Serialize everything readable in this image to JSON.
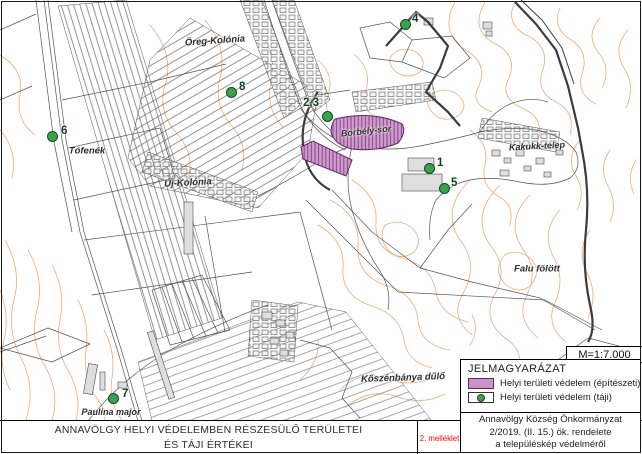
{
  "title_block": {
    "line1": "ANNAVÖLGY HELYI VÉDELEMBEN RÉSZESÜLŐ TERÜLETEI",
    "line2": "ÉS TÁJI ÉRTÉKEI"
  },
  "annex_label": "2. melléklet",
  "scale_label": "M=1:7.000",
  "legend": {
    "title": "JELMAGYARÁZAT",
    "items": [
      {
        "type": "area",
        "label": "Helyi területi védelem (építészeti)",
        "fill": "#cb92c6",
        "border": "#5c2a60"
      },
      {
        "type": "point",
        "label": "Helyi területi védelem (táji)",
        "fill": "#3aa24d",
        "border": "#1c4a23"
      }
    ]
  },
  "attribution": {
    "line1": "Annavölgy Község Önkormányzat",
    "line2": "2/2019. (II. 15.) ök. rendelete",
    "line3": "a településkép védelméről"
  },
  "markers": [
    {
      "label": "4",
      "x": 405,
      "y": 24,
      "lx": 412,
      "ly": 19
    },
    {
      "label": "8",
      "x": 231,
      "y": 92,
      "lx": 239,
      "ly": 87
    },
    {
      "label": "2,3",
      "x": 327,
      "y": 116,
      "lx": 303,
      "ly": 103
    },
    {
      "label": "6",
      "x": 52,
      "y": 136,
      "lx": 61,
      "ly": 131
    },
    {
      "label": "1",
      "x": 429,
      "y": 168,
      "lx": 437,
      "ly": 163
    },
    {
      "label": "5",
      "x": 444,
      "y": 188,
      "lx": 451,
      "ly": 183
    },
    {
      "label": "7",
      "x": 113,
      "y": 398,
      "lx": 122,
      "ly": 394
    }
  ],
  "place_labels": [
    {
      "text": "Öreg-Kolónia",
      "x": 215,
      "y": 41,
      "rot": -4,
      "size": 9.5
    },
    {
      "text": "Tófenék",
      "x": 87,
      "y": 151,
      "rot": 0,
      "size": 9.5
    },
    {
      "text": "Új-Kolónia",
      "x": 188,
      "y": 183,
      "rot": -3,
      "size": 9.5
    },
    {
      "text": "Borbély-sor",
      "x": 366,
      "y": 131,
      "rot": -6,
      "size": 9
    },
    {
      "text": "Kakukk-telep",
      "x": 537,
      "y": 146,
      "rot": -3,
      "size": 9
    },
    {
      "text": "Falu fölött",
      "x": 537,
      "y": 269,
      "rot": 0,
      "size": 9.5
    },
    {
      "text": "Kőszénbánya dűlő",
      "x": 403,
      "y": 378,
      "rot": -2,
      "size": 9.5
    },
    {
      "text": "Paulina major",
      "x": 111,
      "y": 412,
      "rot": 0,
      "size": 9
    }
  ],
  "map_colors": {
    "contour": "#eaa873",
    "parcel": "#555555",
    "boundary": "#3c3c3c",
    "protected_area_fill": "#cb92c6",
    "protected_area_border": "#5c2a60",
    "marker_fill": "#3aa24d",
    "marker_border": "#124a1e",
    "marker_label": "#16401d",
    "annex_color": "#ff0000"
  }
}
